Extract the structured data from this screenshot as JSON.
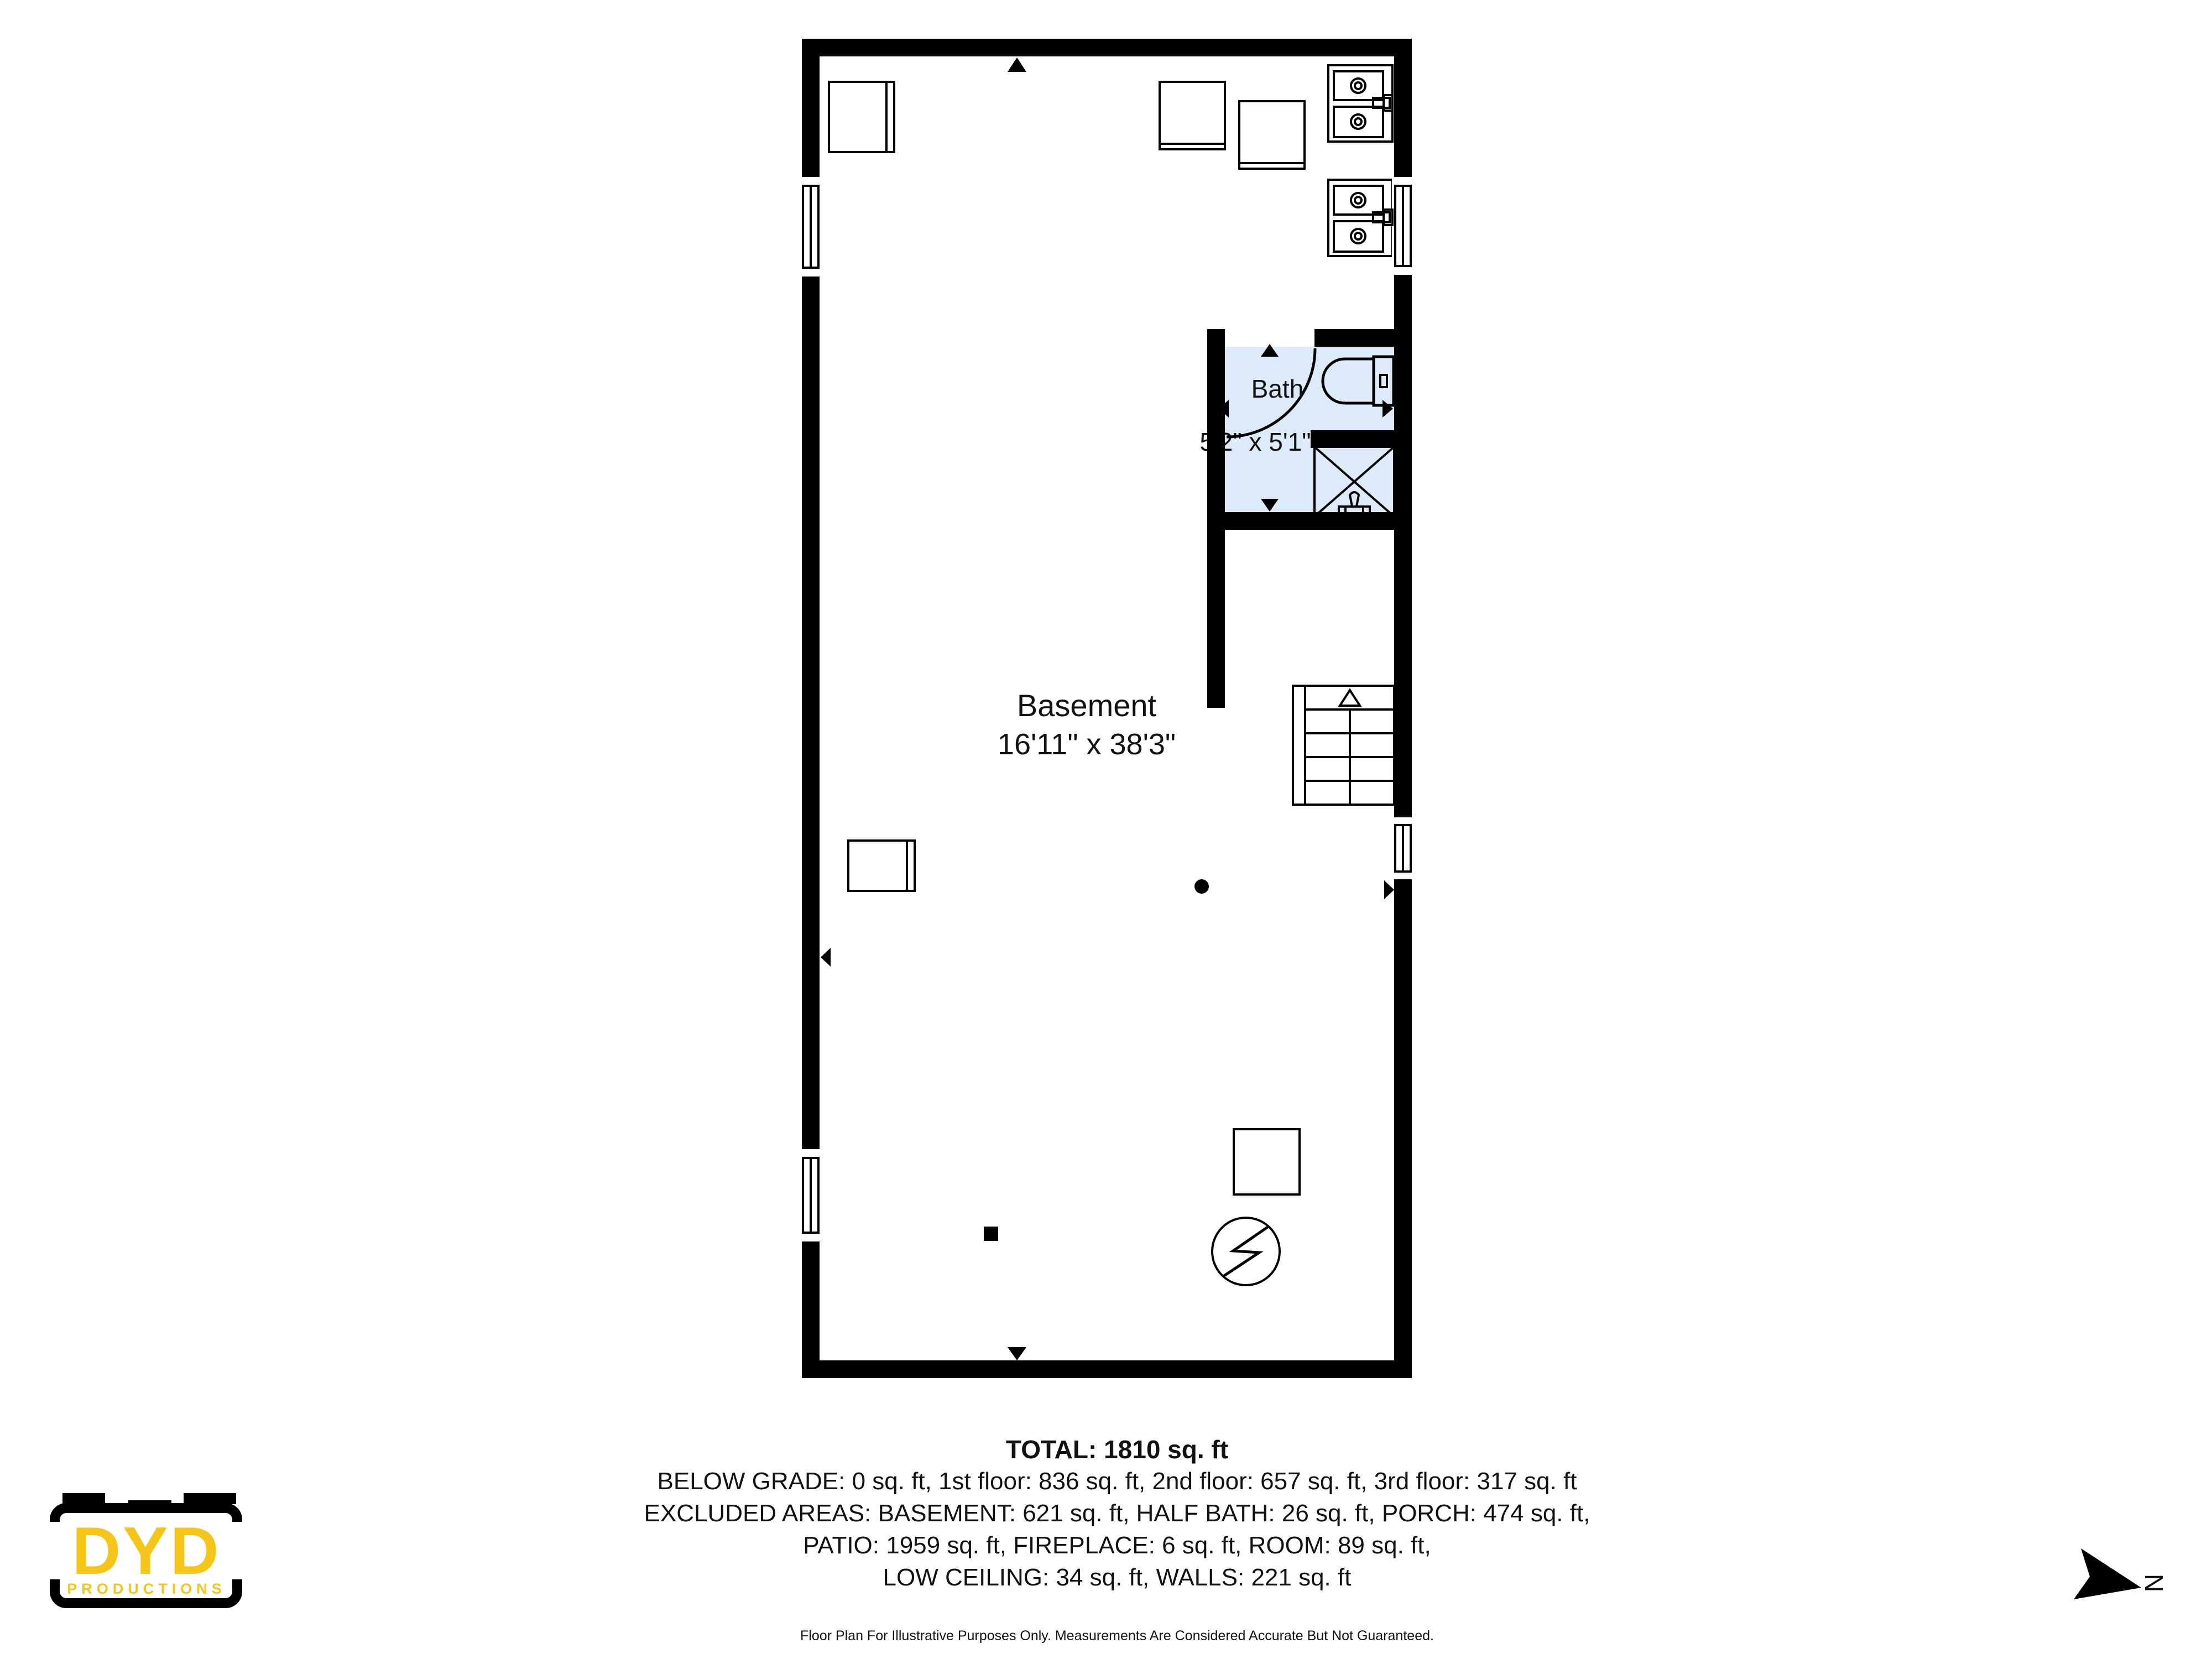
{
  "title": "Basement Floor Plan",
  "colors": {
    "wall": "#000000",
    "bath_fill": "#ddeafa",
    "logo_yellow": "#f6c51a",
    "line": "#000000"
  },
  "rooms": {
    "basement": {
      "name": "Basement",
      "dims": "16'11\" x 38'3\""
    },
    "bath": {
      "name": "Bath",
      "dims": "5'2\" x 5'1\""
    }
  },
  "summary": {
    "total": "TOTAL: 1810 sq. ft",
    "lines": [
      "BELOW GRADE: 0 sq. ft, 1st floor: 836 sq. ft, 2nd floor: 657 sq. ft, 3rd floor: 317 sq. ft",
      "EXCLUDED AREAS: BASEMENT: 621 sq. ft, HALF BATH: 26 sq. ft, PORCH: 474 sq. ft,",
      "PATIO: 1959 sq. ft, FIREPLACE: 6 sq. ft, ROOM: 89 sq. ft,",
      "LOW CEILING: 34 sq. ft, WALLS: 221 sq. ft"
    ],
    "disclaimer": "Floor Plan For Illustrative Purposes Only. Measurements Are Considered Accurate But Not Guaranteed."
  },
  "logo": {
    "name": "DYD",
    "subtitle": "PRODUCTIONS"
  },
  "compass": {
    "label": "N"
  },
  "icons": [
    "toilet-icon",
    "shower-icon",
    "double-sink-icon",
    "stairs-icon",
    "electrical-panel-icon",
    "door-swing-arc-icon",
    "entry-arrow-icon",
    "window-icon",
    "north-arrow-icon",
    "camera-logo-icon"
  ]
}
